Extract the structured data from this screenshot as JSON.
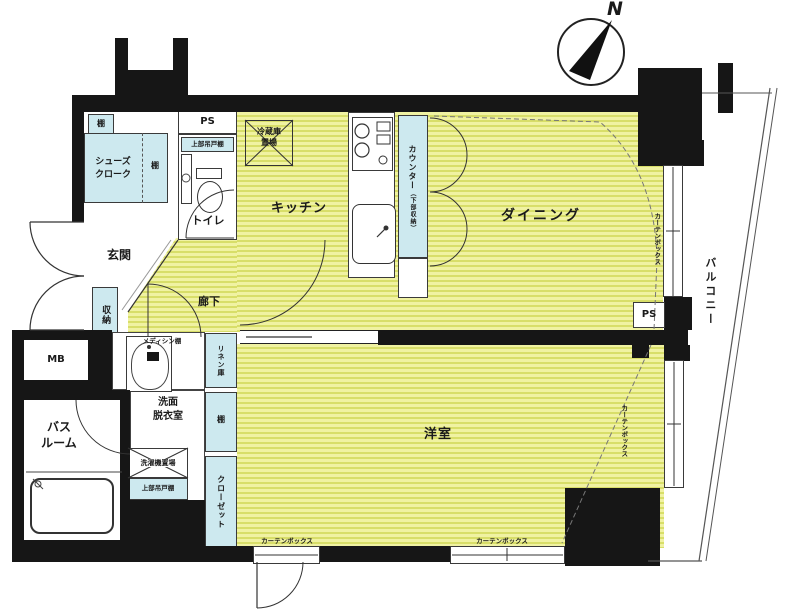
{
  "colors": {
    "wall": "#161616",
    "floor_light": "#f0f2a2",
    "floor_dark": "#d8de69",
    "fixture_aqua": "#cde9ef",
    "line": "#333333"
  },
  "compass": {
    "north": "N"
  },
  "labels": {
    "balcony": "バルコニー",
    "dining": "ダイニング",
    "kitchen": "キッチン",
    "western_room": "洋室",
    "corridor": "廊下",
    "entrance": "玄関",
    "toilet": "トイレ",
    "bath1": "バス",
    "bath2": "ルーム",
    "wash1": "洗面",
    "wash2": "脱衣室",
    "shoes1": "シューズ",
    "shoes2": "クローク",
    "storage": "収納",
    "shelf_a": "棚",
    "shelf_b": "棚",
    "shelf_c": "棚",
    "linen": "リネン庫",
    "closet": "クローゼット",
    "ps_top": "PS",
    "ps_right": "PS",
    "mb": "MB",
    "fridge1": "冷蔵庫",
    "fridge2": "置場",
    "counter_main": "カウンター",
    "counter_sub": "（下部収納）",
    "hang_toilet": "上部吊戸棚",
    "hang_wash": "上部吊戸棚",
    "washer": "洗濯機置場",
    "medicine": "メディシン棚",
    "curtain_a": "カーテンボックス",
    "curtain_b": "カーテンボックス",
    "curtain_c": "カーテンボックス",
    "curtain_d": "カーテンボックス"
  }
}
